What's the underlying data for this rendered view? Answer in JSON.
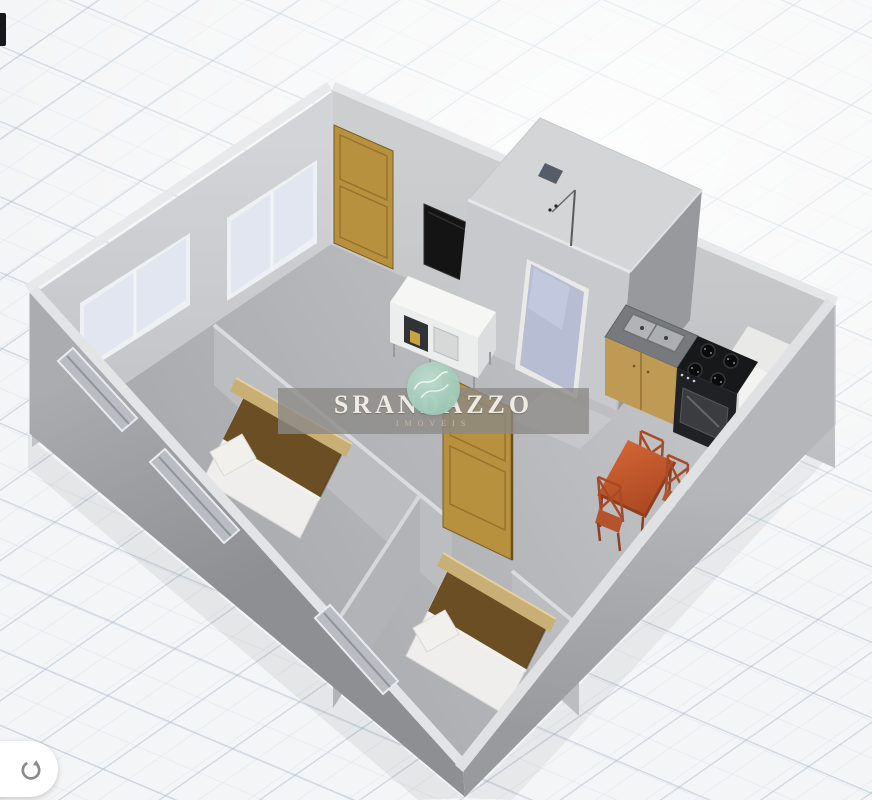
{
  "watermark": {
    "title": "SRANDAZZO",
    "subtitle": "IMÓVEIS"
  },
  "icons": {
    "rotate": "clockwise-rotate-arrow",
    "logo_badge": "script-monogram"
  },
  "colors": {
    "accent-teal": "#9ec9b8",
    "watermark-band": "#8a8987",
    "wood": "#b8913f",
    "wood-dark": "#8a6a2b",
    "duvet-brown": "#6b4e23",
    "headboard": "#c9ae76",
    "table-orange": "#c1542a",
    "chair-orange": "#a84a26",
    "wall-gray": "#c6c7ca",
    "floor-gray": "#b4b5b8",
    "grid-line": "#9fb3c8"
  }
}
